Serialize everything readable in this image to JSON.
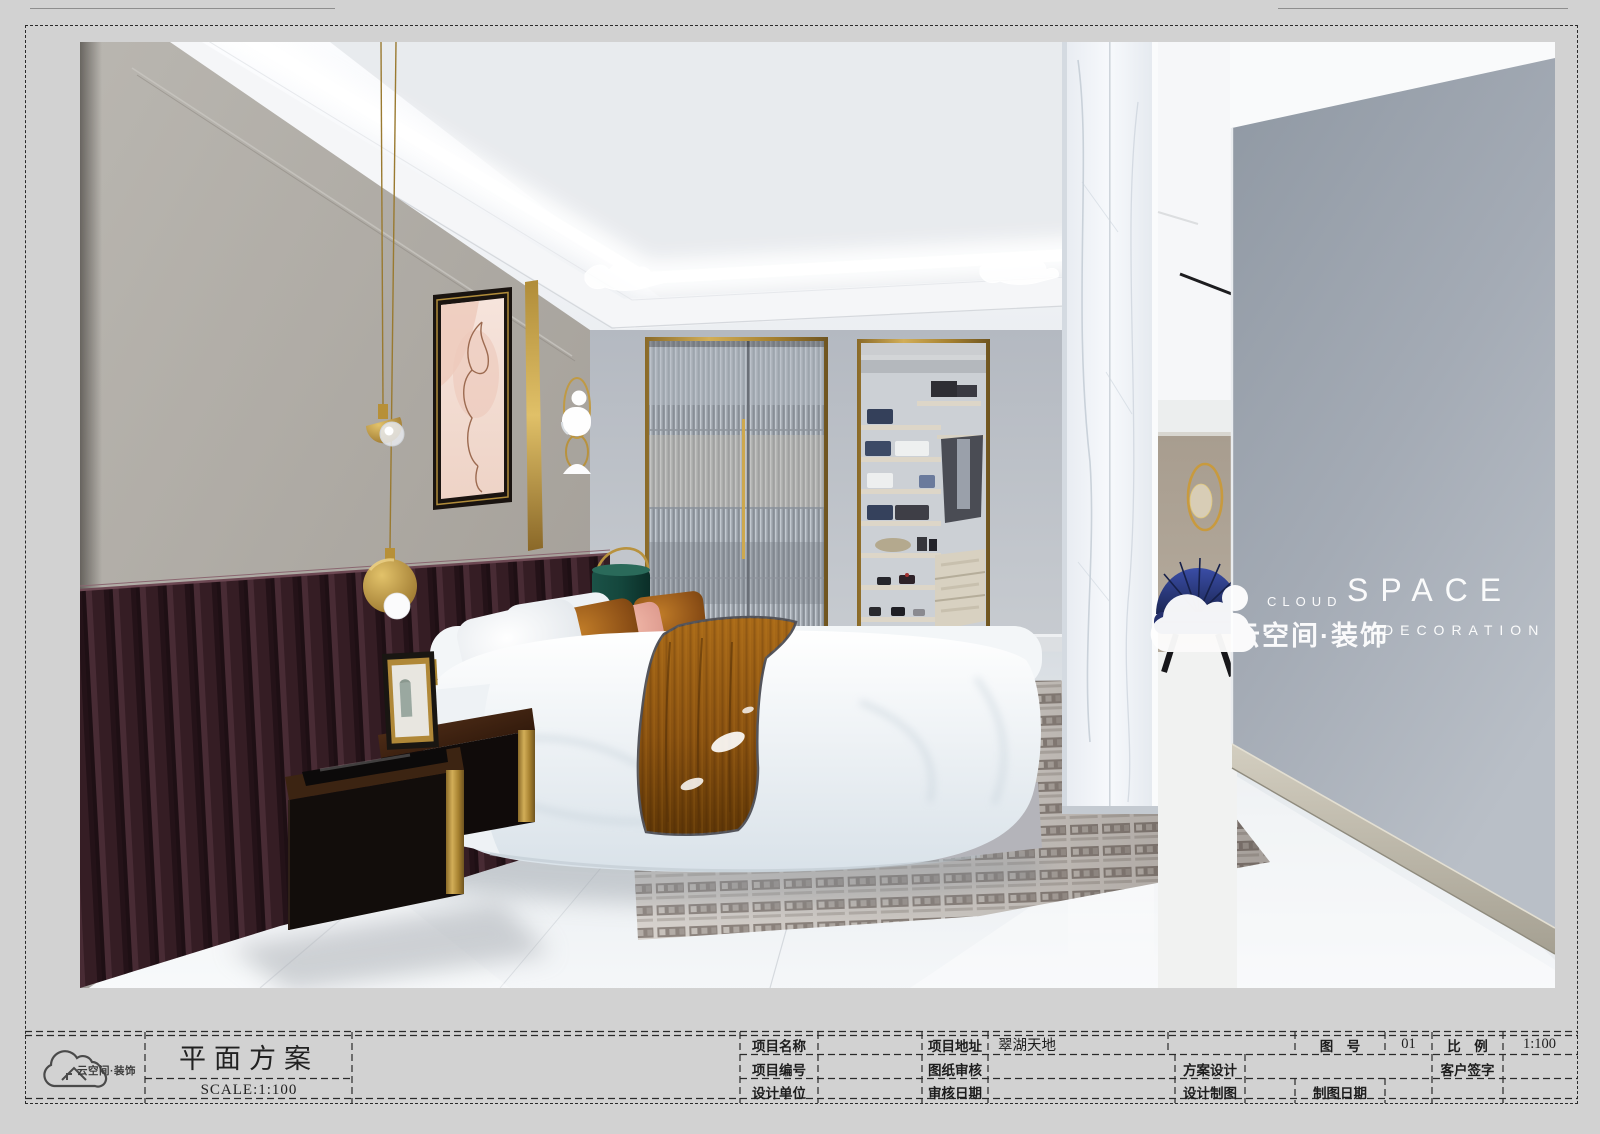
{
  "title_block": {
    "logo": {
      "brand_text": "云空间·装饰"
    },
    "drawing_title": "平面方案",
    "scale_text": "SCALE:1:100",
    "row1": {
      "project_name_label": "项目名称",
      "project_address_label": "项目地址",
      "project_address_value": "翠湖天地",
      "figure_no_label": "图　号",
      "figure_no_value": "01",
      "scale_label": "比　例",
      "scale_value": "1:100"
    },
    "row2": {
      "project_no_label": "项目编号",
      "drawing_review_label": "图纸审核",
      "scheme_design_label": "方案设计",
      "client_signature_label": "客户签字"
    },
    "row3": {
      "design_unit_label": "设计单位",
      "review_date_label": "审核日期",
      "design_drafting_label": "设计制图",
      "drafting_date_label": "制图日期"
    }
  },
  "watermark": {
    "icon": "cloud-icon",
    "top_small": "CLOUD",
    "top_large": "SPACE",
    "bottom_cn": "云空间·装饰",
    "bottom_en": "DECORATION"
  },
  "palette": {
    "sheet_bg": "#d2d2d2",
    "line_color": "#2a2a2a",
    "gold_accent": "#c5a14e",
    "headboard_burgundy": "#42262e",
    "throw_amber": "#95560f",
    "lampshade_teal": "#14463c",
    "back_wall_gray": "#b7bcc3",
    "right_wall_gray": "#9aa2ac",
    "chair_blue": "#2b3a80",
    "pink_pillow": "#ecab9e",
    "rust_pillow": "#9a5a1c",
    "marble_white": "#f2f4f7"
  }
}
